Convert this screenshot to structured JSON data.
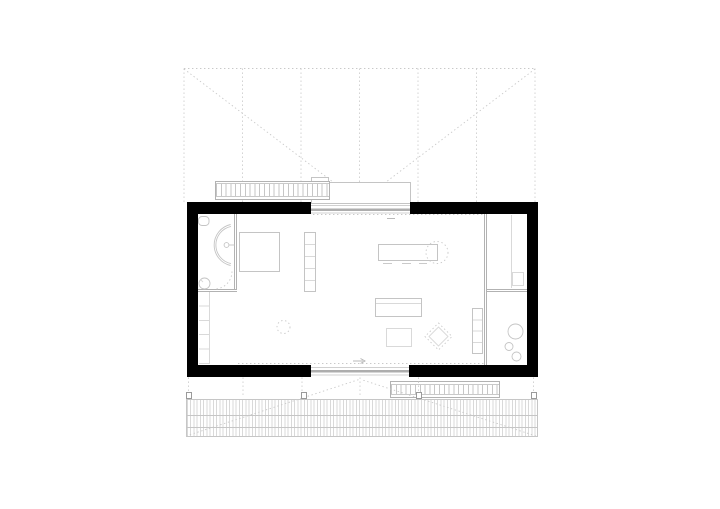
{
  "document": {
    "type": "architectural-floor-plan",
    "content": "single-room house plan with bathroom, wardrobe, kitchen wall, entry ramp, rear stair and full-width timber deck; dashed roof projection",
    "visible_text": ""
  },
  "colors": {
    "background": "#ffffff",
    "wall": "#000000",
    "line": "#c4c4c4",
    "line_light": "#d9d9d9",
    "line_mid": "#b2b2b2",
    "dash": "#c9c9c9",
    "hatch": "#c6c6c6",
    "post": "#9a9a9a",
    "glazing": "#adadad"
  }
}
